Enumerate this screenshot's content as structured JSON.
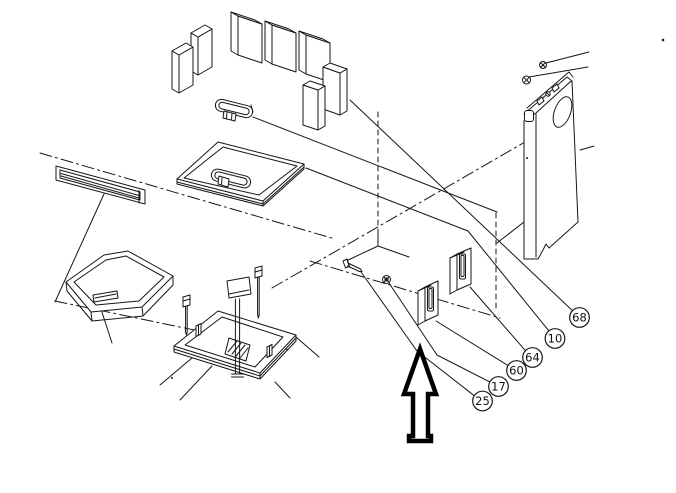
{
  "figure": {
    "kind": "exploded-assembly-parts-diagram",
    "background_color": "#ffffff",
    "line_color": "#161616",
    "arrow_color": "#000000",
    "callouts": [
      {
        "label": "68"
      },
      {
        "label": "10"
      },
      {
        "label": "64"
      },
      {
        "label": "60"
      },
      {
        "label": "17"
      },
      {
        "label": "25"
      }
    ]
  }
}
